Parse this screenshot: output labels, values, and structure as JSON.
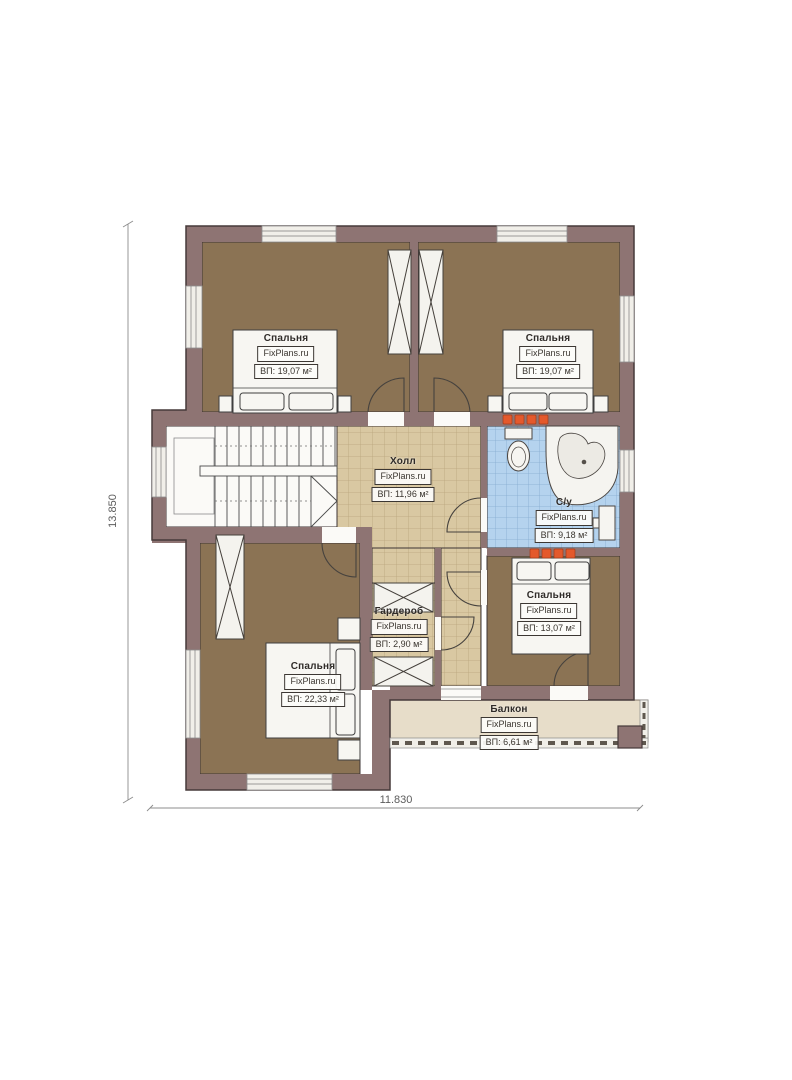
{
  "plan": {
    "watermark": "FixPlans.ru",
    "dimensions": {
      "height": "13.850",
      "width": "11.830"
    },
    "rooms": [
      {
        "name": "Спальня",
        "area": "ВП: 19,07 м²"
      },
      {
        "name": "Спальня",
        "area": "ВП: 19,07 м²"
      },
      {
        "name": "Холл",
        "area": "ВП: 11,96 м²"
      },
      {
        "name": "С/у",
        "area": "ВП: 9,18 м²"
      },
      {
        "name": "Спальня",
        "area": "ВП: 13,07 м²"
      },
      {
        "name": "Гардероб",
        "area": "ВП: 2,90 м²"
      },
      {
        "name": "Спальня",
        "area": "ВП: 22,33 м²"
      },
      {
        "name": "Балкон",
        "area": "ВП: 6,61 м²"
      }
    ],
    "colors": {
      "wall": "#8e7473",
      "bedroom_floor": "#8b7354",
      "hall_floor": "#d9c8a2",
      "bath_floor": "#b5d3ee",
      "balcony_floor": "#e7ddc9",
      "accent": "#e4592c"
    }
  }
}
